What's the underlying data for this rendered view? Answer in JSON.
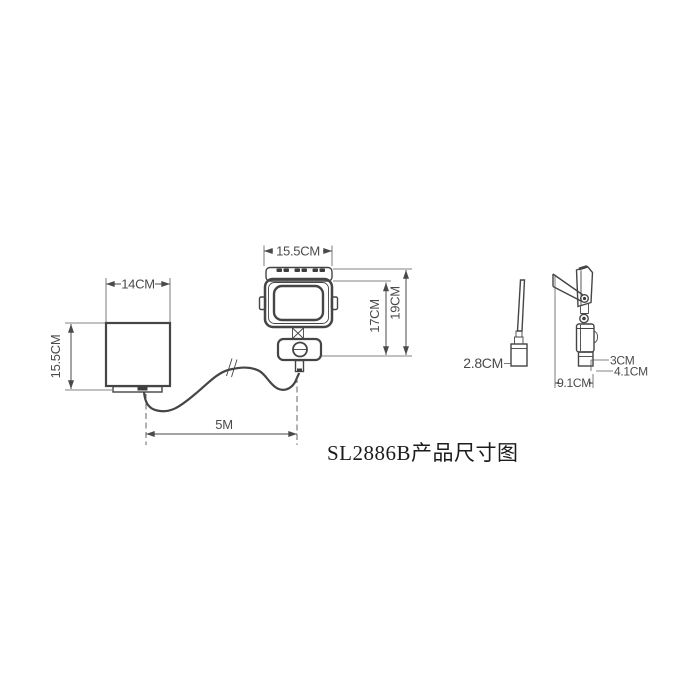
{
  "title": "SL2886B产品尺寸图",
  "diagram_type": "product-dimension-drawing",
  "colors": {
    "line": "#454545",
    "dimension_text": "#4a4a4a",
    "title_text": "#1c1c1c",
    "background": "#ffffff"
  },
  "labels": {
    "solar_front_width": "14CM",
    "solar_front_height": "15.5CM",
    "flood_front_width": "15.5CM",
    "flood_front_height_inner": "17CM",
    "flood_front_height_outer": "19CM",
    "cable_length": "5M",
    "solar_side_depth": "2.8CM",
    "flood_side_body_depth": "3CM",
    "flood_side_full_depth": "4.1CM",
    "flood_side_total_depth": "9.1CM"
  }
}
